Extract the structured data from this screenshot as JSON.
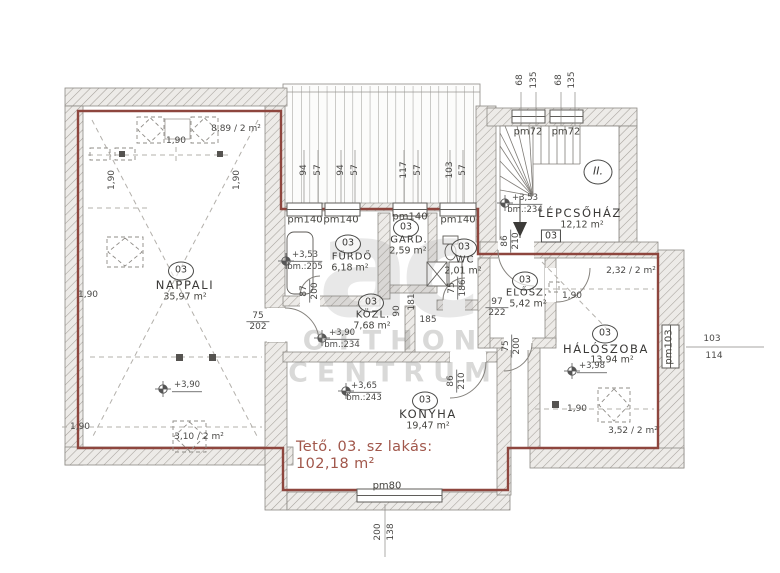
{
  "apartment": {
    "unit": "03",
    "summary_title": "Tető. 03. sz lakás:",
    "summary_area": "102,18 m²",
    "stair_level": "II."
  },
  "rooms": {
    "nappali": {
      "name": "NAPPALI",
      "area": "35,97 m²"
    },
    "furdo": {
      "name": "FÜRDŐ",
      "area": "6,18 m²"
    },
    "gard": {
      "name": "GARD.",
      "area": "2,59 m²"
    },
    "wc": {
      "name": "WC",
      "area": "2,01 m²"
    },
    "kozl": {
      "name": "KÖZL.",
      "area": "7,68 m²"
    },
    "elosz": {
      "name": "ELŐSZ.",
      "area": "5,42 m²"
    },
    "haloszoba": {
      "name": "HÁLÓSZOBA",
      "area": "13,94 m²"
    },
    "konyha": {
      "name": "KONYHA",
      "area": "19,47 m²"
    },
    "lepcsohaz": {
      "name": "LÉPCSŐHÁZ",
      "area": "12,12 m²"
    }
  },
  "levels": {
    "nappali": {
      "v": "+3,90"
    },
    "furdo": {
      "v": "+3,53",
      "bm": "bm.:205"
    },
    "kozl": {
      "v": "+3,90",
      "bm": "bm.:234"
    },
    "konyha": {
      "v": "+3,65",
      "bm": "bm.:243"
    },
    "lepcsohaz": {
      "v": "+3,53",
      "bm": "bm.:234"
    },
    "haloszoba": {
      "v": "+3,98"
    }
  },
  "windows": {
    "pm140": "pm140",
    "pm72": "pm72",
    "pm80": "pm80",
    "pm103": "pm103"
  },
  "chimneys": {
    "top_left": "8,89 / 2 m²",
    "top_right": "2,32 / 2 m²",
    "bottom_right": "3,52 / 2 m²",
    "bottom_left": "3,10 / 2 m²"
  },
  "dims": {
    "d190": "1,90",
    "d185": "185",
    "d90": "90",
    "d181": "181",
    "roof": [
      "94",
      "57",
      "94",
      "57",
      "117",
      "57",
      "103",
      "57"
    ],
    "stair_top": [
      "68",
      "135",
      "68",
      "135"
    ],
    "door_nappali": {
      "t": "75",
      "b": "202"
    },
    "door_furdo": {
      "t": "87",
      "b": "200"
    },
    "door_wc": {
      "t": "75",
      "b": "186"
    },
    "door_elosz": {
      "t": "97",
      "b": "222"
    },
    "door_elosz_b": {
      "t": "75",
      "b": "200"
    },
    "door_entry": {
      "t": "86",
      "b": "210"
    },
    "door_konyha": {
      "t": "86",
      "b": "210"
    },
    "win_right": {
      "t": "103",
      "b": "114"
    },
    "win_bottom": {
      "t": "200",
      "b": "138"
    }
  },
  "watermark": {
    "logo": "ac",
    "line1": "OTTHON",
    "line2": "CENTRUM"
  }
}
